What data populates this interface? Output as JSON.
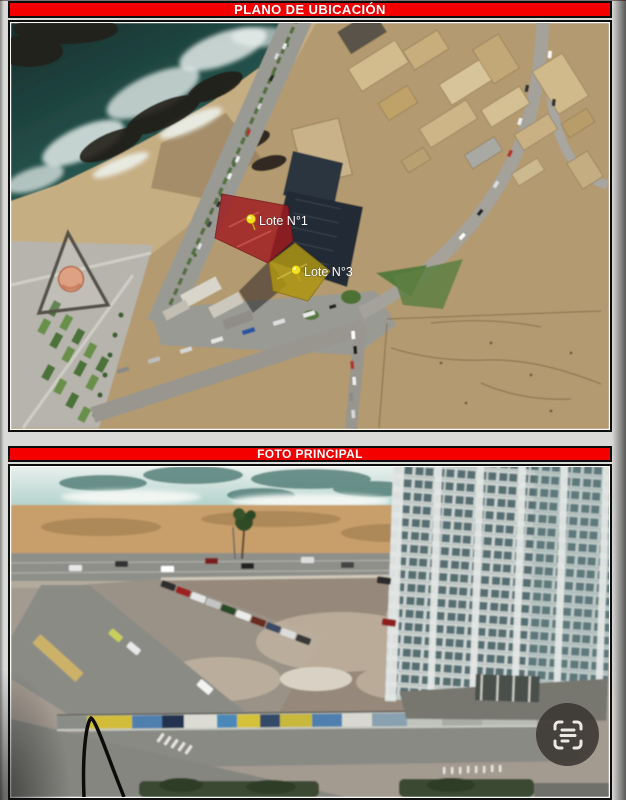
{
  "theme": {
    "page_bg": "#dadad8",
    "header_red": "#f40000",
    "header_text": "#ffffff",
    "frame_border": "#0d0d0d",
    "lot1_fill": "#a01b1f",
    "lot3_fill": "#ad9512",
    "pin_yellow": "#f2df1f",
    "scan_button_bg": "rgba(58,53,48,0.87)"
  },
  "panels": {
    "plano": {
      "title": "PLANO DE UBICACIÓN"
    },
    "foto": {
      "title": "FOTO PRINCIPAL"
    }
  },
  "map": {
    "lot1_label": "Lote N°1",
    "lot3_label": "Lote N°3",
    "pin_icon": "map-pin"
  },
  "viewer": {
    "scan_icon": "scan-text"
  }
}
